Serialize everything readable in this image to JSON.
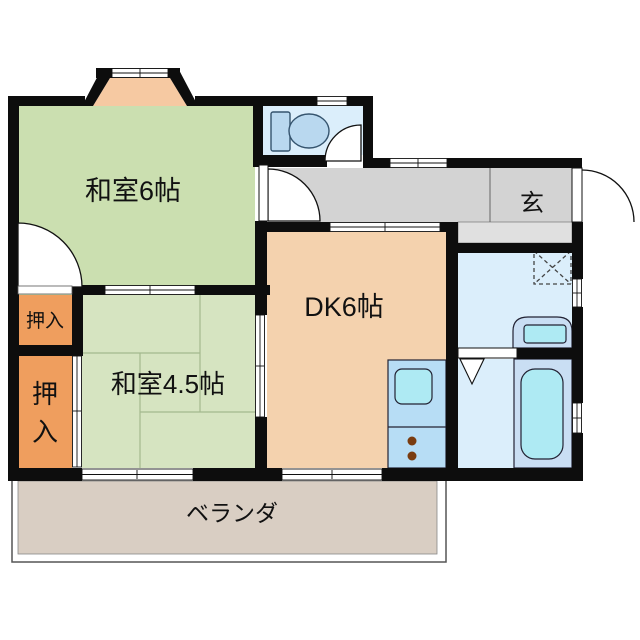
{
  "floorplan": {
    "labels": {
      "washitsu6": "和室6帖",
      "washitsu45": "和室4.5帖",
      "dk": "DK6帖",
      "genkan": "玄",
      "oshiire_upper": "押入",
      "oshiire_lower": "押入",
      "oshiire_lower_top_char": "押",
      "oshiire_lower_bottom_char": "入",
      "veranda": "ベランダ"
    },
    "colors": {
      "wall": "#0d0d0d",
      "tatami_6": "#cbdfb0",
      "tatami_45": "#d6e4c1",
      "dk_floor": "#f4d2ae",
      "closet": "#ef9e5e",
      "bay_window": "#f6c9a2",
      "hallway": "#d3d3d3",
      "genkan_step": "#e0e0e0",
      "wet_room": "#dbeefb",
      "fixture_fill": "#b9d8ef",
      "fixture_cyan": "#aeeaf3",
      "fixture_shell": "#c9def3",
      "kitchen_unit": "#b7ddf5",
      "burner_brown": "#7a3c10",
      "veranda_floor": "#d9cec3"
    },
    "fixtures": {
      "toilet": "toilet-icon",
      "washing_machine_space": "washing-machine-space-icon",
      "washbasin": "washbasin-icon",
      "bathtub": "bathtub-icon",
      "kitchen_sink": "kitchen-sink-icon",
      "stove": "stove-burners-icon"
    }
  }
}
